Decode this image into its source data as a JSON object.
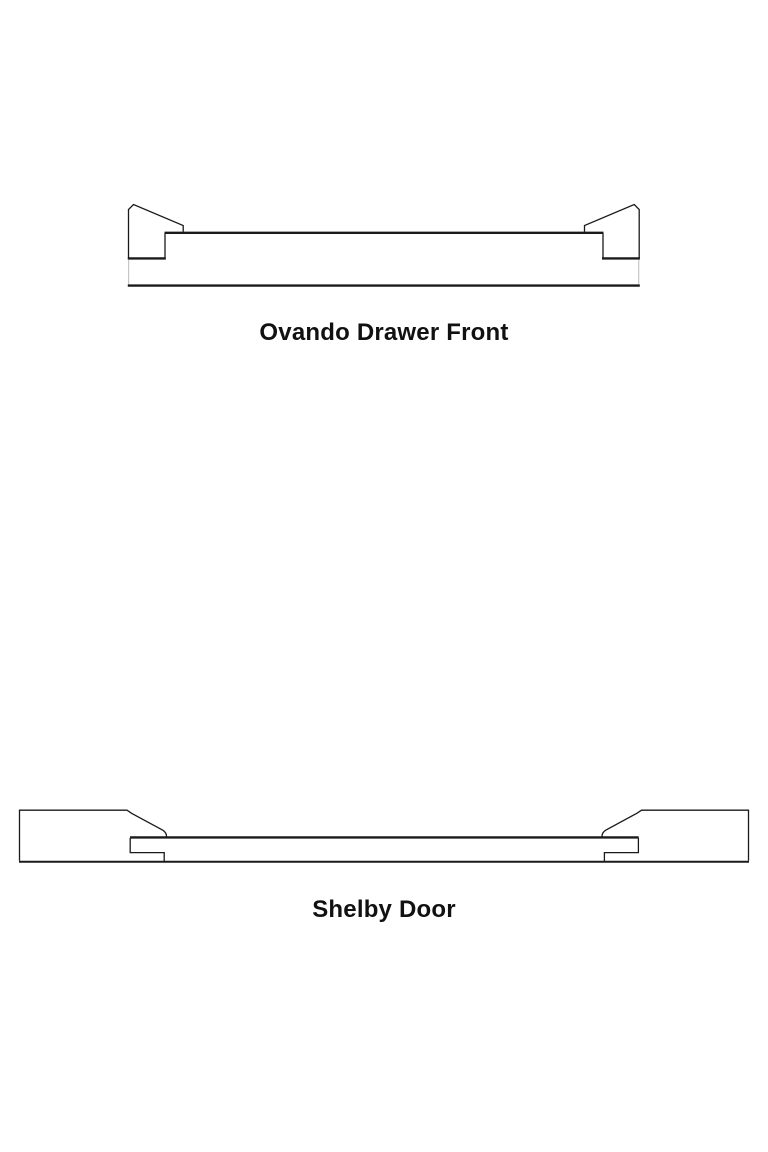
{
  "page": {
    "background_color": "#ffffff",
    "text_color": "#111111"
  },
  "colors": {
    "line": "#1a1a1a",
    "light_line": "#c6c6c6"
  },
  "figures": [
    {
      "caption": "Ovando Drawer Front"
    },
    {
      "caption": "Shelby Door"
    }
  ]
}
